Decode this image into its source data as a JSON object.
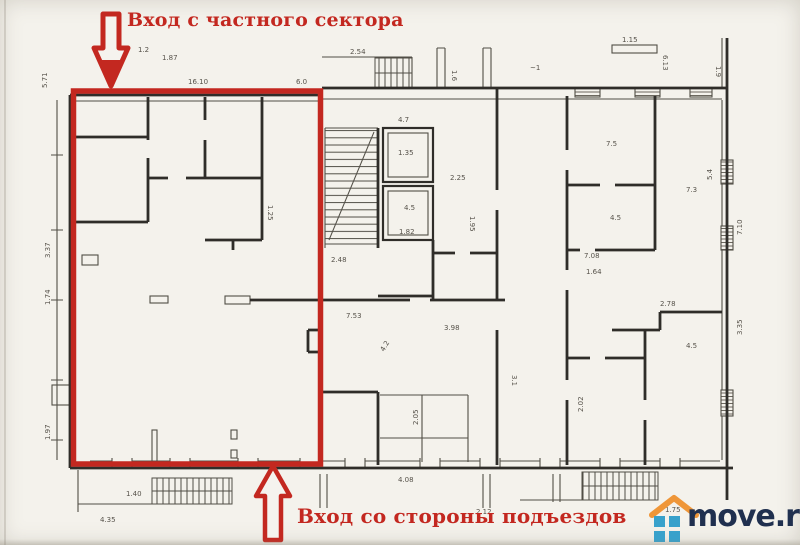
{
  "annotations": {
    "top_label": "Вход с частного сектора",
    "bottom_label": "Вход со стороны подъездов",
    "highlight_color": "#c32820"
  },
  "watermark": {
    "text": "move.ru",
    "text_color": "#20304f",
    "roof_color": "#ef9638",
    "squares_color": "#38a1cb"
  },
  "plan": {
    "paper_color": "#f4f2ec",
    "line_color": "#2f2d29",
    "dimension_labels": [
      {
        "t": "2.54",
        "x": 350,
        "y": 54,
        "r": 0
      },
      {
        "t": "1.87",
        "x": 162,
        "y": 60,
        "r": 0
      },
      {
        "t": "16.10",
        "x": 188,
        "y": 84,
        "r": 0
      },
      {
        "t": "1.2",
        "x": 138,
        "y": 52,
        "r": 0
      },
      {
        "t": "6.0",
        "x": 296,
        "y": 84,
        "r": 0
      },
      {
        "t": "1.15",
        "x": 622,
        "y": 42,
        "r": 0
      },
      {
        "t": "6.13",
        "x": 663,
        "y": 55,
        "r": 90
      },
      {
        "t": "1.9",
        "x": 716,
        "y": 66,
        "r": 90
      },
      {
        "t": "~1",
        "x": 530,
        "y": 70,
        "r": 0
      },
      {
        "t": "1.6",
        "x": 452,
        "y": 70,
        "r": 90
      },
      {
        "t": "5.71",
        "x": 47,
        "y": 88,
        "r": -90
      },
      {
        "t": "3.37",
        "x": 50,
        "y": 258,
        "r": -90
      },
      {
        "t": "1.74",
        "x": 50,
        "y": 305,
        "r": -90
      },
      {
        "t": "1.97",
        "x": 50,
        "y": 440,
        "r": -90
      },
      {
        "t": "4.35",
        "x": 100,
        "y": 522,
        "r": 0
      },
      {
        "t": "1.40",
        "x": 126,
        "y": 496,
        "r": 0
      },
      {
        "t": "2.48",
        "x": 331,
        "y": 262,
        "r": 0
      },
      {
        "t": "4.7",
        "x": 398,
        "y": 122,
        "r": 0
      },
      {
        "t": "1.35",
        "x": 398,
        "y": 155,
        "r": 0
      },
      {
        "t": "4.5",
        "x": 404,
        "y": 210,
        "r": 0
      },
      {
        "t": "1.82",
        "x": 399,
        "y": 234,
        "r": 0
      },
      {
        "t": "2.25",
        "x": 450,
        "y": 180,
        "r": 0
      },
      {
        "t": "1.95",
        "x": 470,
        "y": 216,
        "r": 90
      },
      {
        "t": "7.53",
        "x": 346,
        "y": 318,
        "r": 0
      },
      {
        "t": "3.98",
        "x": 444,
        "y": 330,
        "r": 0
      },
      {
        "t": "3.1",
        "x": 512,
        "y": 375,
        "r": 90
      },
      {
        "t": "4.2",
        "x": 384,
        "y": 352,
        "r": -60
      },
      {
        "t": "2.05",
        "x": 418,
        "y": 425,
        "r": -90
      },
      {
        "t": "4.08",
        "x": 398,
        "y": 482,
        "r": 0
      },
      {
        "t": "2.12",
        "x": 476,
        "y": 514,
        "r": 0
      },
      {
        "t": "1.25",
        "x": 268,
        "y": 205,
        "r": 90
      },
      {
        "t": "7.5",
        "x": 606,
        "y": 146,
        "r": 0
      },
      {
        "t": "4.5",
        "x": 610,
        "y": 220,
        "r": 0
      },
      {
        "t": "7.3",
        "x": 686,
        "y": 192,
        "r": 0
      },
      {
        "t": "5.4",
        "x": 712,
        "y": 180,
        "r": -90
      },
      {
        "t": "1.64",
        "x": 586,
        "y": 274,
        "r": 0
      },
      {
        "t": "2.78",
        "x": 660,
        "y": 306,
        "r": 0
      },
      {
        "t": "4.5",
        "x": 686,
        "y": 348,
        "r": 0
      },
      {
        "t": "7.08",
        "x": 584,
        "y": 258,
        "r": 0
      },
      {
        "t": "2.02",
        "x": 583,
        "y": 412,
        "r": -90
      },
      {
        "t": "7.10",
        "x": 742,
        "y": 235,
        "r": -90
      },
      {
        "t": "3.35",
        "x": 742,
        "y": 335,
        "r": -90
      },
      {
        "t": "1.75",
        "x": 665,
        "y": 512,
        "r": 0
      }
    ]
  }
}
